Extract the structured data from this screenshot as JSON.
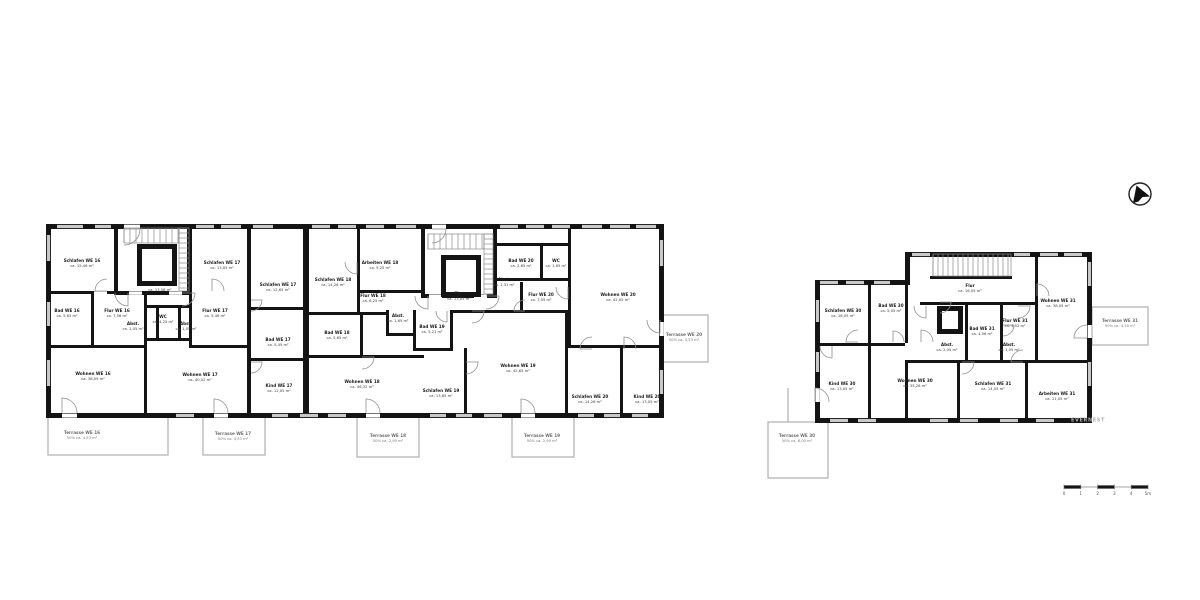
{
  "colors": {
    "wall": "#141414",
    "window": "#c9c9c9",
    "terrace_outline": "#b5b5b5",
    "door_arc": "#8f8f8f",
    "stair_tread": "#8a8a8a",
    "background": "#ffffff"
  },
  "north_arrow": {
    "icon": "north-arrow",
    "direction": "north-east"
  },
  "watermark": {
    "text": "EVERNEST"
  },
  "scale_bar": {
    "ticks": [
      "0",
      "1",
      "2",
      "3",
      "4",
      "5m"
    ]
  },
  "buildings": [
    {
      "id": "left-building",
      "rooms": [
        {
          "name": "Schlafen WE 16",
          "area": "ca. 15,46 m²",
          "x": 82,
          "y": 262
        },
        {
          "name": "Bad WE 16",
          "area": "ca. 5,65 m²",
          "x": 67,
          "y": 312
        },
        {
          "name": "Flur WE 16",
          "area": "ca. 7,56 m²",
          "x": 117,
          "y": 312
        },
        {
          "name": "Abst.",
          "area": "ca. 1,05 m²",
          "x": 133,
          "y": 325
        },
        {
          "name": "WC",
          "area": "ca. 4,25 m²",
          "x": 163,
          "y": 318
        },
        {
          "name": "Abst.",
          "area": "ca. 1,05 m²",
          "x": 186,
          "y": 325
        },
        {
          "name": "Flur",
          "area": "ca. 13,58 m²",
          "x": 160,
          "y": 286
        },
        {
          "name": "Schlafen WE 17",
          "area": "ca. 13,05 m²",
          "x": 222,
          "y": 264
        },
        {
          "name": "Flur WE 17",
          "area": "ca. 5,46 m²",
          "x": 215,
          "y": 312
        },
        {
          "name": "Schlafen WE 17",
          "area": "ca. 12,65 m²",
          "x": 278,
          "y": 286
        },
        {
          "name": "Bad WE 17",
          "area": "ca. 5,45 m²",
          "x": 278,
          "y": 341
        },
        {
          "name": "Kind WE 17",
          "area": "ca. 12,05 m²",
          "x": 279,
          "y": 387
        },
        {
          "name": "Wohnen WE 16",
          "area": "ca. 38,09 m²",
          "x": 93,
          "y": 375
        },
        {
          "name": "Wohnen WE 17",
          "area": "ca. 40,02 m²",
          "x": 200,
          "y": 376
        },
        {
          "name": "Schlafen WE 18",
          "area": "ca. 14,26 m²",
          "x": 333,
          "y": 281
        },
        {
          "name": "Arbeiten WE 18",
          "area": "ca. 9,25 m²",
          "x": 380,
          "y": 264
        },
        {
          "name": "Flur WE 18",
          "area": "ca. 6,25 m²",
          "x": 373,
          "y": 297
        },
        {
          "name": "Abst.",
          "area": "ca. 1,65 m²",
          "x": 398,
          "y": 317
        },
        {
          "name": "Bad WE 18",
          "area": "ca. 5,65 m²",
          "x": 337,
          "y": 334
        },
        {
          "name": "Wohnen WE 18",
          "area": "ca. 46,32 m²",
          "x": 362,
          "y": 383
        },
        {
          "name": "Flur",
          "area": "ca. 13,05 m²",
          "x": 459,
          "y": 295
        },
        {
          "name": "Bad WE 20",
          "area": "ca. 2,65 m²",
          "x": 521,
          "y": 262
        },
        {
          "name": "WC",
          "area": "ca. 1,65 m²",
          "x": 556,
          "y": 262
        },
        {
          "name": "Abst.",
          "area": "ca. 1,31 m²",
          "x": 504,
          "y": 281
        },
        {
          "name": "Flur WE 20",
          "area": "ca. 7,05 m²",
          "x": 541,
          "y": 296
        },
        {
          "name": "Bad WE 19",
          "area": "ca. 5,21 m²",
          "x": 432,
          "y": 328
        },
        {
          "name": "Schlafen WE 19",
          "area": "ca. 13,65 m²",
          "x": 441,
          "y": 392
        },
        {
          "name": "Wohnen WE 19",
          "area": "ca. 42,65 m²",
          "x": 518,
          "y": 367
        },
        {
          "name": "Wohnen WE 20",
          "area": "ca. 42,05 m²",
          "x": 618,
          "y": 296
        },
        {
          "name": "Schlafen WE 20",
          "area": "ca. 14,26 m²",
          "x": 590,
          "y": 398
        },
        {
          "name": "Kind WE 20",
          "area": "ca. 13,05 m²",
          "x": 647,
          "y": 398
        }
      ],
      "terraces": [
        {
          "name": "Terrasse WE 16",
          "area": "50% ca. 4,53 m²",
          "x": 82,
          "y": 434
        },
        {
          "name": "Terrasse WE 17",
          "area": "50% ca. 4,53 m²",
          "x": 233,
          "y": 435
        },
        {
          "name": "Terrasse WE 18",
          "area": "50% ca. 2,90 m²",
          "x": 388,
          "y": 437
        },
        {
          "name": "Terrasse WE 19",
          "area": "50% ca. 2,90 m²",
          "x": 542,
          "y": 437
        },
        {
          "name": "Terrasse WE 20",
          "area": "50% ca. 4,53 m²",
          "x": 684,
          "y": 336
        }
      ]
    },
    {
      "id": "right-building",
      "rooms": [
        {
          "name": "Schlafen WE 30",
          "area": "ca. 16,05 m²",
          "x": 843,
          "y": 312
        },
        {
          "name": "Bad WE 30",
          "area": "ca. 5,05 m²",
          "x": 891,
          "y": 307
        },
        {
          "name": "Flur",
          "area": "ca. 16,05 m²",
          "x": 970,
          "y": 287
        },
        {
          "name": "Wohnen WE 31",
          "area": "ca. 38,05 m²",
          "x": 1058,
          "y": 302
        },
        {
          "name": "Flur WE 31",
          "area": "ca. 4,52 m²",
          "x": 1015,
          "y": 322
        },
        {
          "name": "Bad WE 31",
          "area": "ca. 4,56 m²",
          "x": 982,
          "y": 330
        },
        {
          "name": "Abst.",
          "area": "ca. 2,05 m²",
          "x": 947,
          "y": 346
        },
        {
          "name": "Abst.",
          "area": "ca. 1,05 m²",
          "x": 1009,
          "y": 346
        },
        {
          "name": "Kind WE 30",
          "area": "ca. 13,05 m²",
          "x": 842,
          "y": 385
        },
        {
          "name": "Wohnen WE 30",
          "area": "ca. 35,26 m²",
          "x": 915,
          "y": 382
        },
        {
          "name": "Schlafen WE 31",
          "area": "ca. 14,05 m²",
          "x": 993,
          "y": 385
        },
        {
          "name": "Arbeiten WE 31",
          "area": "ca. 11,05 m²",
          "x": 1057,
          "y": 395
        }
      ],
      "terraces": [
        {
          "name": "Terrasse WE 30",
          "area": "50% ca. 8,00 m²",
          "x": 797,
          "y": 437
        },
        {
          "name": "Terrasse WE 31",
          "area": "50% ca. 4,30 m²",
          "x": 1120,
          "y": 322
        }
      ]
    }
  ]
}
